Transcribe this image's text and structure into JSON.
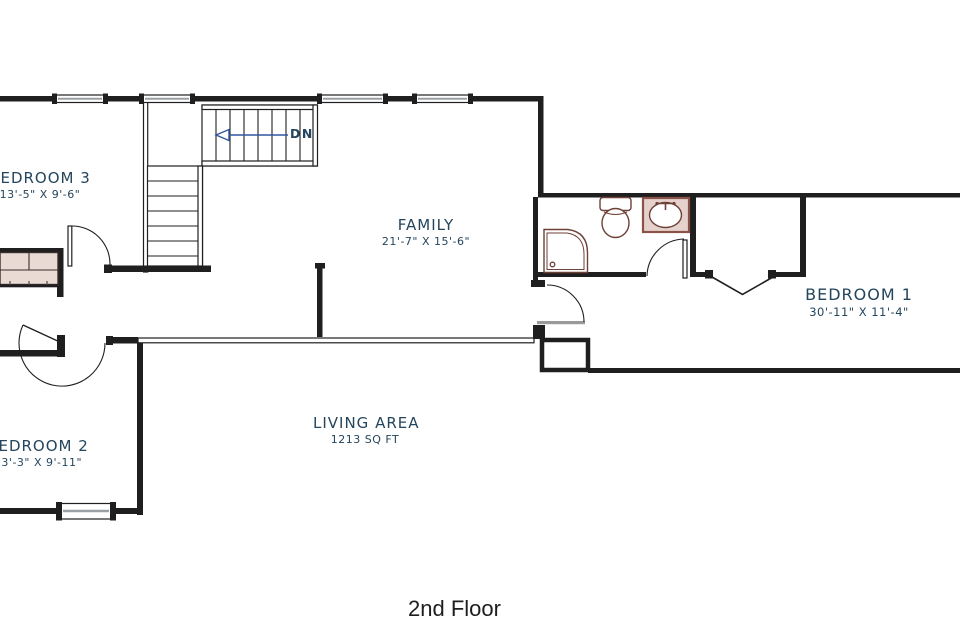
{
  "floor_plan": {
    "title": "2nd Floor",
    "stairs": {
      "label": "DN"
    },
    "rooms": [
      {
        "name": "BEDROOM 3",
        "dims": "13'-5\" X 9'-6\""
      },
      {
        "name": "FAMILY",
        "dims": "21'-7\" X 15'-6\""
      },
      {
        "name": "BEDROOM 1",
        "dims": "30'-11\" X 11'-4\""
      },
      {
        "name": "BEDROOM 2",
        "dims": "13'-3\" X 9'-11\""
      },
      {
        "name": "LIVING AREA",
        "dims": "1213 SQ FT"
      }
    ]
  },
  "colors": {
    "wall": "#1f1f1f",
    "ink": "#24455c",
    "fixture": "#6d4038",
    "counter": "#e5d2cc",
    "closet": "#e9dad4",
    "glass": "#9aa0a4",
    "arrow": "#3056a0",
    "half": "#9a9a9a",
    "title": "#1e1e1e"
  }
}
